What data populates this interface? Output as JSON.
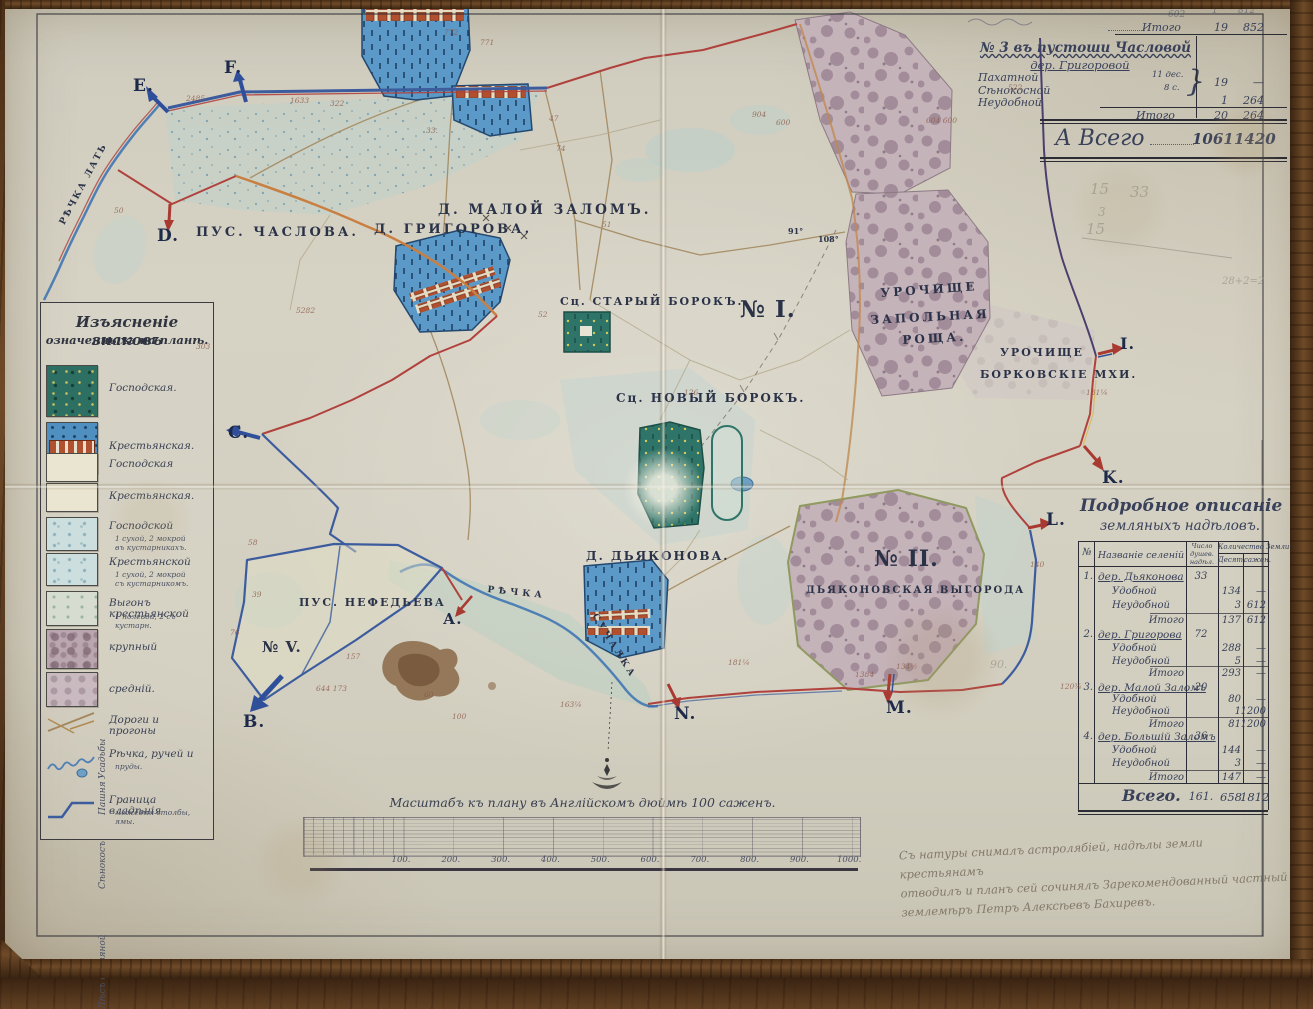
{
  "colors": {
    "paper": "#d4d0c2",
    "wood": "#6e4a28",
    "ink": "#2e3440",
    "boundary_red": "#b0413c",
    "boundary_blue": "#3c5c9e",
    "settlement_blue": "#5b9ac8",
    "house_red": "#b0502f",
    "manor_teal": "#2e7468",
    "forest_mauve": "#b9a6ae",
    "meadow": "#ccdedd",
    "road_brown": "#a3885e",
    "pencil": "#8a857a"
  },
  "top_table": {
    "carry_label": "Итого",
    "carry_v1": "19",
    "carry_v2": "852",
    "title1": "№ 3 въ пустоши Часловой",
    "title2": "дер. Григоровой",
    "rows": [
      {
        "label": "Пахатной",
        "note": "11 дес."
      },
      {
        "label": "Сѣнокосной",
        "note": "8 с."
      },
      {
        "label": "Неудобной",
        "note": ""
      }
    ],
    "brace_glyph": "}",
    "group_v1": "19",
    "group_v2": "—",
    "neud_v1": "1",
    "neud_v2": "264",
    "sub_label": "Итого",
    "sub_v1": "20",
    "sub_v2": "264",
    "total_label": "А Всего",
    "total_v1": "1061",
    "total_v2": "1420"
  },
  "legend": {
    "title1": "Изъясненіе знаковъ",
    "title2": "означенныхъ на планѣ.",
    "groups": [
      {
        "label": "Усадьбы",
        "y": 476
      },
      {
        "label": "Пашня",
        "y": 512
      },
      {
        "label": "Сѣнокосъ",
        "y": 586
      },
      {
        "label": "Лѣсъ дровяной",
        "y": 706
      }
    ],
    "items": [
      {
        "type": "manor-estate",
        "label": "Господская.",
        "y": 62,
        "h": 50,
        "ly": 80
      },
      {
        "type": "peasant-estate",
        "label": "Крестьянская.",
        "y": 119,
        "h": 50,
        "ly": 138
      },
      {
        "type": "field",
        "label": "Господская",
        "y": 150,
        "h": 27,
        "ly": 156
      },
      {
        "type": "field",
        "label": "Крестьянская.",
        "y": 180,
        "h": 27,
        "ly": 188
      },
      {
        "type": "meadow",
        "label": "Господской",
        "y": 214,
        "h": 32,
        "ly": 218,
        "sub": [
          "1 сухой, 2 мокрой",
          "въ кустарникахъ."
        ],
        "sy": 232
      },
      {
        "type": "meadow",
        "label": "Крестьянской",
        "y": 250,
        "h": 31,
        "ly": 254,
        "sub": [
          "1 сухой, 2 мокрой",
          "съ кустарникомъ."
        ],
        "sy": 268
      },
      {
        "type": "pasture",
        "label": "Выгонъ крестьянской",
        "y": 288,
        "h": 33,
        "ly": 295,
        "sub": [
          "1 полевой, 2 съ кустарн."
        ],
        "sy": 310
      },
      {
        "type": "forest-lg",
        "label": "крупный",
        "y": 326,
        "h": 38,
        "ly": 339
      },
      {
        "type": "forest-md",
        "label": "средній.",
        "y": 369,
        "h": 33,
        "ly": 381
      },
      {
        "type": "roads",
        "label": "Дороги и прогоны",
        "y": 404,
        "h": 30,
        "ly": 412
      },
      {
        "type": "river",
        "label": "Рѣчка, ручей и",
        "y": 438,
        "h": 44,
        "ly": 446,
        "sub": [
          "пруды."
        ],
        "sy": 460
      },
      {
        "type": "border",
        "label": "Граница владѣнія",
        "y": 488,
        "h": 36,
        "ly": 492,
        "sub": [
          "межевыя столбы, ямы."
        ],
        "sy": 506
      }
    ]
  },
  "detail_table": {
    "title1": "Подробное описаніе",
    "title2": "земляныхъ надѣловъ.",
    "headers": {
      "num": "№",
      "name": "Названіе селеній",
      "souls": [
        "Число",
        "душев.",
        "надѣл."
      ],
      "land": "Количество Земли",
      "des": "Десят.",
      "saz": "сажен."
    },
    "rows": [
      {
        "y": 571,
        "num": "1.",
        "name": "дер. Дьяконова",
        "souls": "33",
        "cls": "village"
      },
      {
        "y": 586,
        "name": "Удобной",
        "des": "134",
        "saz": "—",
        "cls": "sub"
      },
      {
        "y": 600,
        "name": "Неудобной",
        "des": "3",
        "saz": "612",
        "cls": "sub"
      },
      {
        "y": 615,
        "name": "Итого",
        "des": "137",
        "saz": "612",
        "cls": "subtotal"
      },
      {
        "y": 629,
        "num": "2.",
        "name": "дер. Григорова",
        "souls": "72",
        "cls": "village"
      },
      {
        "y": 643,
        "name": "Удобной",
        "des": "288",
        "saz": "—",
        "cls": "sub"
      },
      {
        "y": 656,
        "name": "Неудобной",
        "des": "5",
        "saz": "—",
        "cls": "sub"
      },
      {
        "y": 668,
        "name": "Итого",
        "des": "293",
        "saz": "—",
        "cls": "subtotal"
      },
      {
        "y": 682,
        "num": "3.",
        "name": "дер. Малой Заломъ",
        "souls": "20",
        "cls": "village"
      },
      {
        "y": 694,
        "name": "Удобной",
        "des": "80",
        "saz": "—",
        "cls": "sub"
      },
      {
        "y": 706,
        "name": "Неудобной",
        "des": "1",
        "saz": "1200",
        "cls": "sub"
      },
      {
        "y": 719,
        "name": "Итого",
        "des": "81",
        "saz": "1200",
        "cls": "subtotal"
      },
      {
        "y": 731,
        "num": "4.",
        "name": "дер. Большій Заломъ",
        "souls": "36",
        "cls": "village"
      },
      {
        "y": 745,
        "name": "Удобной",
        "des": "144",
        "saz": "—",
        "cls": "sub"
      },
      {
        "y": 758,
        "name": "Неудобной",
        "des": "3",
        "saz": "—",
        "cls": "sub"
      },
      {
        "y": 772,
        "name": "Итого",
        "des": "147",
        "saz": "—",
        "cls": "subtotal"
      }
    ],
    "total": {
      "label": "Всего.",
      "souls": "161.",
      "des": "658",
      "saz": "1812"
    }
  },
  "scale": {
    "title": "Масштабъ къ плану въ Англійскомъ дюймѣ 100 саженъ.",
    "ticks": [
      "100.",
      "200.",
      "300.",
      "400.",
      "500.",
      "600.",
      "700.",
      "800.",
      "900.",
      "1000."
    ]
  },
  "inscription": {
    "lines": [
      "Съ натуры снималъ астролябіей, надѣлы земли крестьянамъ",
      "отводилъ и планъ сей сочинялъ Зарекомендованный частный",
      "землемѣръ Петръ Алексѣевъ Бахиревъ."
    ]
  },
  "letters": [
    {
      "t": "E.",
      "x": 133,
      "y": 76
    },
    {
      "t": "F.",
      "x": 224,
      "y": 58
    },
    {
      "t": "D.",
      "x": 157,
      "y": 226
    },
    {
      "t": "C.",
      "x": 228,
      "y": 423
    },
    {
      "t": "А.",
      "x": 443,
      "y": 610,
      "fs": 15
    },
    {
      "t": "B.",
      "x": 243,
      "y": 712
    },
    {
      "t": "N.",
      "x": 674,
      "y": 704
    },
    {
      "t": "M.",
      "x": 886,
      "y": 698
    },
    {
      "t": "L.",
      "x": 1046,
      "y": 510
    },
    {
      "t": "K.",
      "x": 1102,
      "y": 468
    },
    {
      "t": "I.",
      "x": 1120,
      "y": 334,
      "fs": 16
    }
  ],
  "places": [
    {
      "t": "ПУС. ЧАСЛОВА.",
      "x": 196,
      "y": 225,
      "fs": 13,
      "ls": 3
    },
    {
      "t": "Д. МАЛОЙ ЗАЛОМЪ.",
      "x": 438,
      "y": 202,
      "fs": 13.5,
      "ls": 3
    },
    {
      "t": "Д. ГРИГОРОВА.",
      "x": 374,
      "y": 222,
      "fs": 13,
      "ls": 3
    },
    {
      "t": "Сц. СТАРЫЙ БОРОКЪ.",
      "x": 560,
      "y": 295,
      "fs": 11,
      "ls": 2
    },
    {
      "t": "Сц. НОВЫЙ БОРОКЪ.",
      "x": 616,
      "y": 391,
      "fs": 12,
      "ls": 2
    },
    {
      "t": "№ I.",
      "x": 740,
      "y": 296,
      "fs": 23,
      "ls": 1,
      "b": 1
    },
    {
      "t": "УРОЧИЩЕ",
      "x": 880,
      "y": 286,
      "fs": 12,
      "ls": 3,
      "rot": -4
    },
    {
      "t": "ЗАПОЛЬНАЯ",
      "x": 870,
      "y": 313,
      "fs": 12,
      "ls": 3,
      "rot": -3
    },
    {
      "t": "РОЩА.",
      "x": 902,
      "y": 333,
      "fs": 12,
      "ls": 3,
      "rot": -3
    },
    {
      "t": "УРОЧИЩЕ",
      "x": 1000,
      "y": 346,
      "fs": 11,
      "ls": 2
    },
    {
      "t": "БОРКОВСКІЕ МХИ.",
      "x": 980,
      "y": 368,
      "fs": 11,
      "ls": 2
    },
    {
      "t": "Д. ДЬЯКОНОВА.",
      "x": 586,
      "y": 549,
      "fs": 12,
      "ls": 2
    },
    {
      "t": "№ II.",
      "x": 874,
      "y": 546,
      "fs": 22,
      "ls": 1,
      "b": 1
    },
    {
      "t": "ДЬЯКОНОВСКАЯ ВЫГОРОДА",
      "x": 806,
      "y": 585,
      "fs": 10,
      "ls": 2
    },
    {
      "t": "ПУС. НЕФЕДЬЕВА",
      "x": 299,
      "y": 596,
      "fs": 11,
      "ls": 2
    },
    {
      "t": "№ V.",
      "x": 262,
      "y": 638,
      "fs": 15,
      "ls": 1,
      "b": 1
    },
    {
      "t": "РѢЧКА ЛАТЬ",
      "x": 58,
      "y": 222,
      "fs": 9,
      "ls": 2,
      "rot": -62
    },
    {
      "t": "РѢЧКА",
      "x": 488,
      "y": 585,
      "fs": 9,
      "ls": 4,
      "rot": 6
    },
    {
      "t": "СУЧАЛКА",
      "x": 598,
      "y": 612,
      "fs": 9,
      "ls": 3,
      "rot": 58
    },
    {
      "t": "91°",
      "x": 788,
      "y": 226,
      "fs": 8
    },
    {
      "t": "108°",
      "x": 818,
      "y": 234,
      "fs": 8
    }
  ],
  "numbers": [
    {
      "t": "772",
      "x": 444,
      "y": 28
    },
    {
      "t": "771",
      "x": 480,
      "y": 38
    },
    {
      "t": "1633",
      "x": 290,
      "y": 96
    },
    {
      "t": "322",
      "x": 330,
      "y": 99
    },
    {
      "t": "2485",
      "x": 186,
      "y": 94
    },
    {
      "t": "33.",
      "x": 426,
      "y": 126
    },
    {
      "t": "47",
      "x": 549,
      "y": 114
    },
    {
      "t": "74",
      "x": 556,
      "y": 144
    },
    {
      "t": "51",
      "x": 602,
      "y": 220
    },
    {
      "t": "5282",
      "x": 296,
      "y": 306
    },
    {
      "t": "904",
      "x": 752,
      "y": 110
    },
    {
      "t": "600",
      "x": 776,
      "y": 118
    },
    {
      "t": "604 600",
      "x": 926,
      "y": 116
    },
    {
      "t": "522",
      "x": 1008,
      "y": 83
    },
    {
      "t": "157",
      "x": 346,
      "y": 652
    },
    {
      "t": "644 173",
      "x": 316,
      "y": 684
    },
    {
      "t": "140",
      "x": 1030,
      "y": 560
    },
    {
      "t": "1384",
      "x": 855,
      "y": 670
    },
    {
      "t": "181¼",
      "x": 728,
      "y": 658
    },
    {
      "t": "134½",
      "x": 896,
      "y": 662
    },
    {
      "t": "120¾",
      "x": 1060,
      "y": 682
    },
    {
      "t": "131¼",
      "x": 1086,
      "y": 388
    },
    {
      "t": "58",
      "x": 248,
      "y": 538
    },
    {
      "t": "39",
      "x": 252,
      "y": 590
    },
    {
      "t": "76",
      "x": 230,
      "y": 628
    },
    {
      "t": "60",
      "x": 424,
      "y": 690
    },
    {
      "t": "50",
      "x": 114,
      "y": 206
    },
    {
      "t": "303",
      "x": 196,
      "y": 342
    },
    {
      "t": "52",
      "x": 538,
      "y": 310
    },
    {
      "t": "126",
      "x": 684,
      "y": 388
    },
    {
      "t": "100",
      "x": 452,
      "y": 712
    },
    {
      "t": "163¼",
      "x": 560,
      "y": 700
    }
  ],
  "pencil": [
    {
      "t": "15",
      "x": 1090,
      "y": 180,
      "fs": 15
    },
    {
      "t": "33",
      "x": 1130,
      "y": 183,
      "fs": 15
    },
    {
      "t": "3",
      "x": 1098,
      "y": 205,
      "fs": 12
    },
    {
      "t": "15",
      "x": 1086,
      "y": 220,
      "fs": 15
    },
    {
      "t": "28+2=2",
      "x": 1222,
      "y": 276,
      "fs": 10
    },
    {
      "t": "90.",
      "x": 990,
      "y": 658,
      "fs": 11
    }
  ],
  "faint_top": [
    {
      "t": "602",
      "x": 1168,
      "y": 10
    },
    {
      "t": "1",
      "x": 1212,
      "y": 6
    },
    {
      "t": "812",
      "x": 1238,
      "y": 6
    }
  ]
}
